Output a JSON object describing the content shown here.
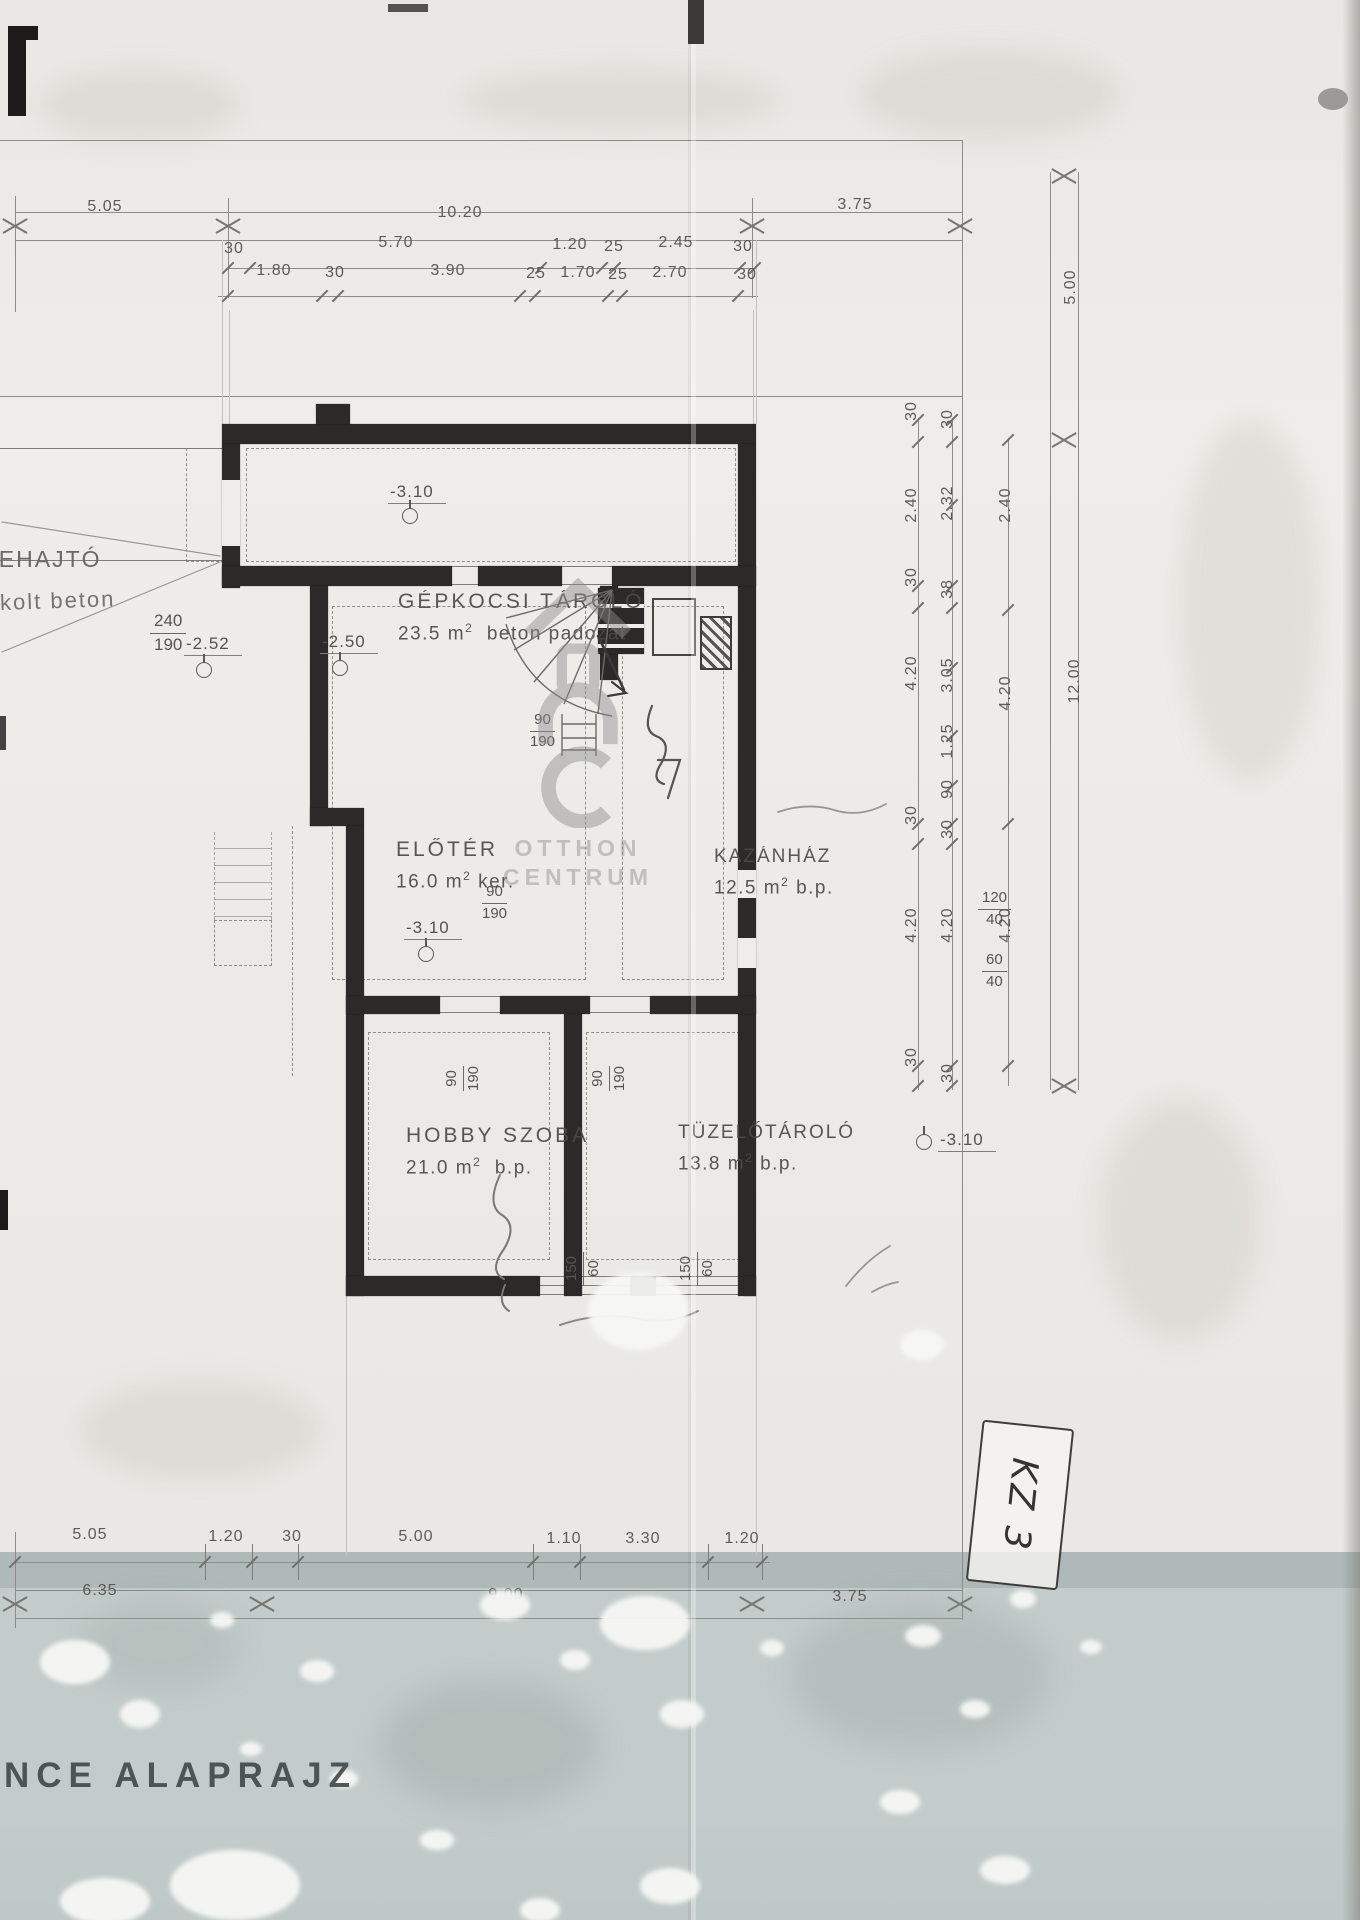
{
  "document": {
    "title_visible": "NCE ALAPRAJZ",
    "stamp": "KZ 3",
    "watermark": {
      "line1": "OTTHON",
      "line2": "CENTRUM"
    }
  },
  "rooms": {
    "garage": {
      "name": "GÉPKOCSI TÁROLÓ",
      "area": "23.5 m",
      "sup": "2",
      "note": "beton padozat"
    },
    "eloter": {
      "name": "ELŐTÉR",
      "area": "16.0 m",
      "sup": "2",
      "note": "ker."
    },
    "kazan": {
      "name": "KAZÁNHÁZ",
      "area": "12.5 m",
      "sup": "2",
      "note": "b.p."
    },
    "hobby": {
      "name": "HOBBY SZOBA",
      "area": "21.0 m",
      "sup": "2",
      "note": "b.p."
    },
    "tuzelo": {
      "name": "TÜZELŐTÁROLÓ",
      "area": "13.8 m",
      "sup": "2",
      "note": "b.p."
    }
  },
  "labels": {
    "ramp": "LEHAJTÓ",
    "ramp_note": "kolt beton"
  },
  "levels": {
    "garage": "-3.10",
    "ramp_a": "-2.52",
    "ramp_b": "-2.50",
    "eloter": "-3.10",
    "tuzelo": "-3.10"
  },
  "fractions": {
    "garage_door": {
      "top": "240",
      "bottom": "190"
    },
    "stair_door": {
      "top": "90",
      "bottom": "190"
    },
    "eloter_door": {
      "top": "90",
      "bottom": "190"
    },
    "hobby_door": {
      "top": "90",
      "bottom": "190"
    },
    "tuzelo_door": {
      "top": "90",
      "bottom": "190"
    },
    "window_a": {
      "top": "120",
      "bottom": "40"
    },
    "window_b": {
      "top": "60",
      "bottom": "40"
    },
    "window_c": {
      "top": "150",
      "bottom": "60"
    },
    "window_d": {
      "top": "150",
      "bottom": "60"
    }
  },
  "dimensions": {
    "top_row1": [
      "5.05",
      "10.20",
      "3.75"
    ],
    "top_row2": [
      "30",
      "5.70",
      "1.20",
      "25",
      "2.45",
      "30"
    ],
    "top_row3": [
      "1.80",
      "30",
      "3.90",
      "25",
      "1.70",
      "25",
      "2.70",
      "30"
    ],
    "right_outer_top": "5.00",
    "right_outer": "12.00",
    "right_col1": [
      "30",
      "2.40",
      "30",
      "4.20",
      "30",
      "4.20",
      "30"
    ],
    "right_col2": [
      "30",
      "2.32",
      "38",
      "3.05",
      "1.25",
      "90",
      "30",
      "4.20",
      "30"
    ],
    "right_col3": [
      "2.40",
      "4.20",
      "4.20"
    ],
    "bottom_row1": [
      "5.05",
      "1.20",
      "30",
      "5.00",
      "1.10",
      "3.30",
      "1.20"
    ],
    "bottom_row2": [
      "6.35",
      "9.00",
      "3.75"
    ]
  }
}
